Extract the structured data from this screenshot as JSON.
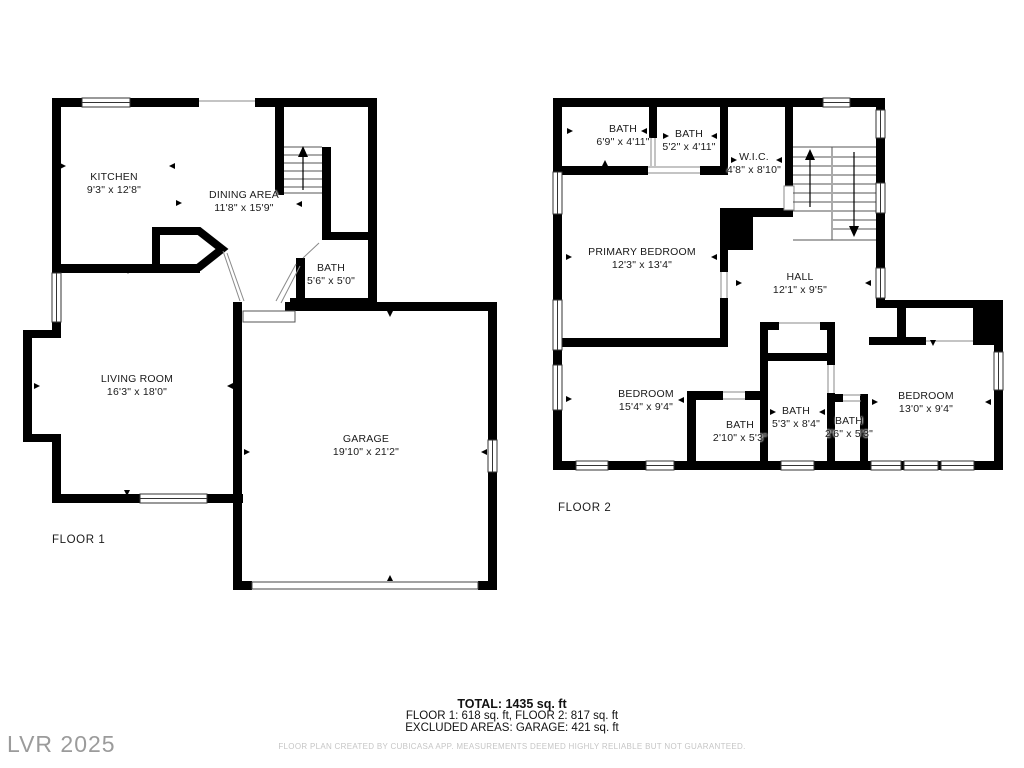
{
  "colors": {
    "wall": "#000000",
    "thin_line": "#8a8a8a",
    "text": "#1a1a1a",
    "disclaimer": "#c6c6c6",
    "watermark": "#9b9b9b"
  },
  "floors": [
    {
      "label": "FLOOR 1",
      "rooms": [
        {
          "name": "KITCHEN",
          "dims": "9'3\" x 12'8\""
        },
        {
          "name": "DINING AREA",
          "dims": "11'8\" x 15'9\""
        },
        {
          "name": "BATH",
          "dims": "5'6\" x 5'0\""
        },
        {
          "name": "LIVING ROOM",
          "dims": "16'3\" x 18'0\""
        },
        {
          "name": "GARAGE",
          "dims": "19'10\" x 21'2\""
        }
      ]
    },
    {
      "label": "FLOOR 2",
      "rooms": [
        {
          "name": "BATH",
          "dims": "6'9\" x 4'11\""
        },
        {
          "name": "BATH",
          "dims": "5'2\" x 4'11\""
        },
        {
          "name": "W.I.C.",
          "dims": "4'8\" x 8'10\""
        },
        {
          "name": "PRIMARY BEDROOM",
          "dims": "12'3\" x 13'4\""
        },
        {
          "name": "HALL",
          "dims": "12'1\" x 9'5\""
        },
        {
          "name": "BEDROOM",
          "dims": "15'4\" x 9'4\""
        },
        {
          "name": "BATH",
          "dims": "2'10\" x 5'3\""
        },
        {
          "name": "BATH",
          "dims": "5'3\" x 8'4\""
        },
        {
          "name": "BATH",
          "dims": "2'6\" x 5'3\""
        },
        {
          "name": "BEDROOM",
          "dims": "13'0\" x 9'4\""
        }
      ]
    }
  ],
  "summary": {
    "total": "TOTAL: 1435 sq. ft",
    "floors_line": "FLOOR 1: 618 sq. ft, FLOOR 2: 817 sq. ft",
    "excluded_line": "EXCLUDED AREAS: GARAGE: 421 sq. ft",
    "disclaimer": "FLOOR PLAN CREATED BY CUBICASA APP. MEASUREMENTS DEEMED HIGHLY RELIABLE BUT NOT GUARANTEED."
  },
  "watermark": "LVR 2025"
}
